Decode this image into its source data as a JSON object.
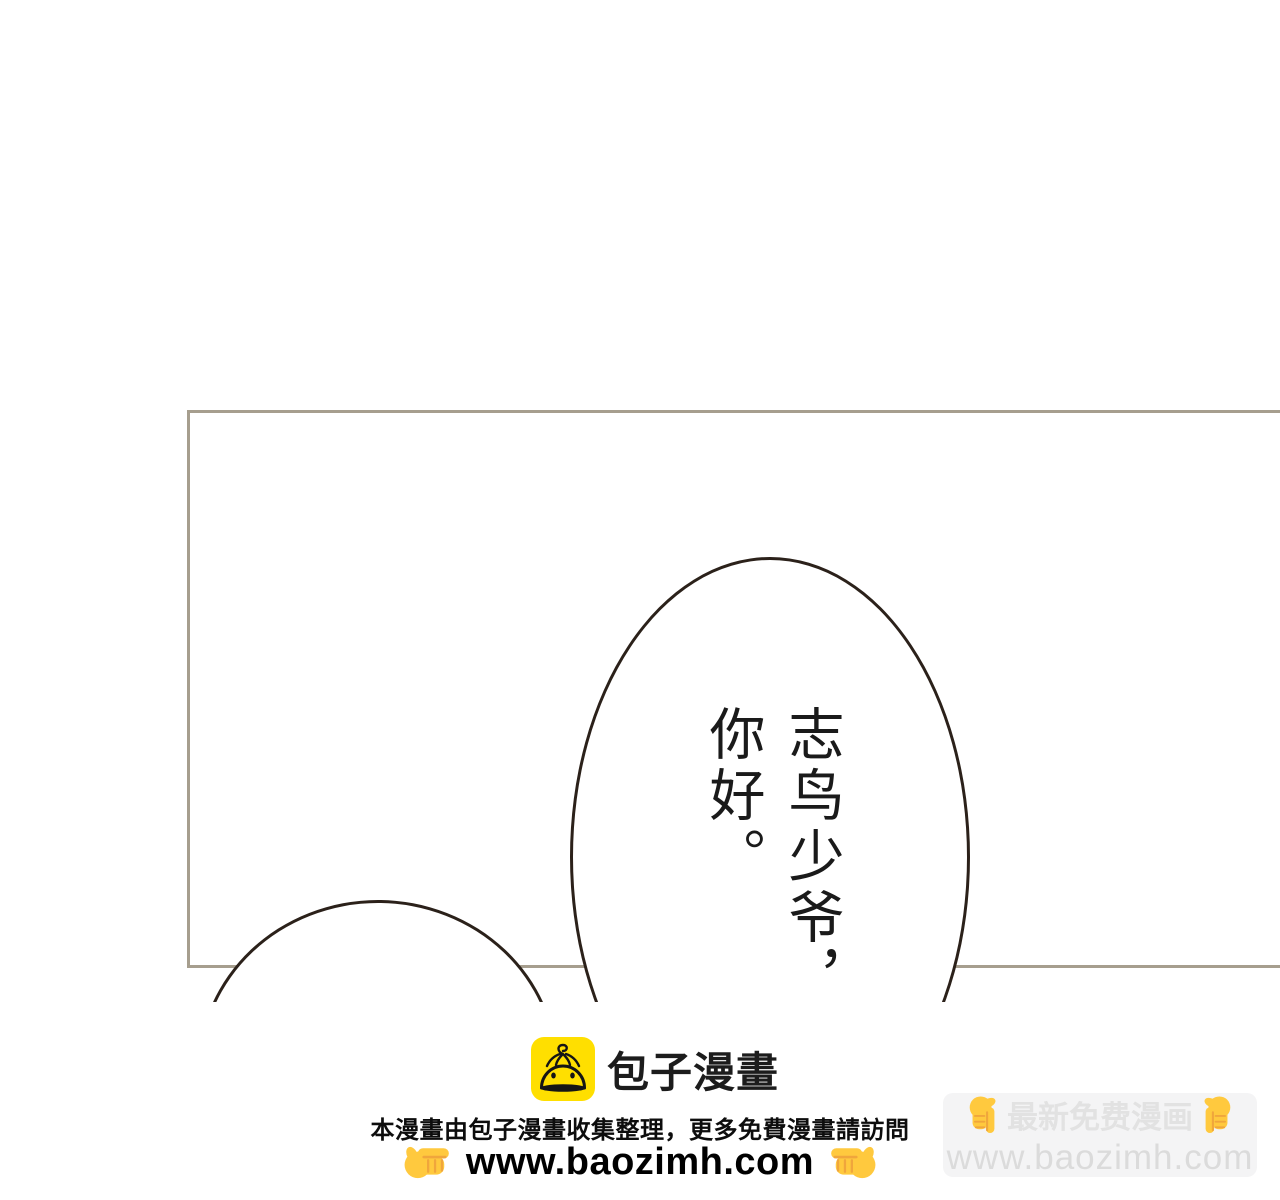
{
  "page": {
    "background": "#ffffff"
  },
  "comic": {
    "panel": {
      "border_color": "#a69e8e"
    },
    "bubbles": {
      "outline_color": "#2b211a",
      "fill": "#ffffff"
    },
    "speech": {
      "line1": "志鸟少爷，",
      "line2": "你好。",
      "text_color": "#1a1a1a"
    }
  },
  "footer": {
    "brand": {
      "name": "包子漫畫",
      "logo_icon": "baozi-bun-logo",
      "logo_color": "#ffdf00"
    },
    "notice": "本漫畫由包子漫畫收集整理，更多免費漫畫請訪問",
    "url": "www.baozimh.com",
    "hand_color": "#ffc93e",
    "watermark": {
      "title": "最新免费漫画",
      "url": "www.baozimh.com",
      "bg": "#f4f4f5",
      "title_color": "#e2e2e2",
      "url_color": "#dbdbdb"
    }
  }
}
